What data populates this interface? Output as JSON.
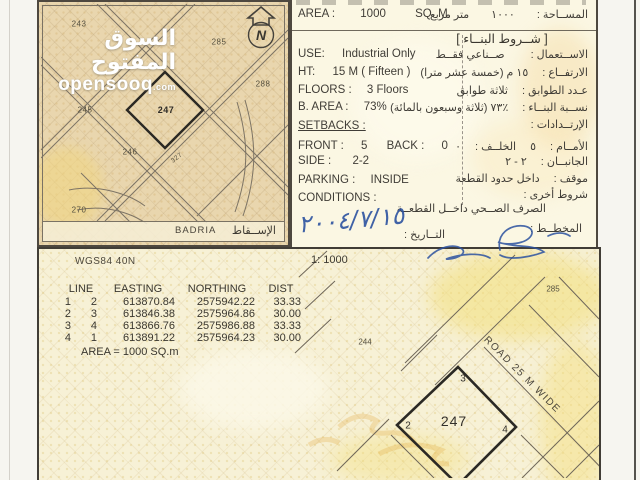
{
  "colors": {
    "paper": "#f6f5f0",
    "map_tan": "#e9d6ae",
    "form_cream": "#fbf7e3",
    "survey_pale": "#f7f1d6",
    "ink_blue": "#2c52a0",
    "line_dark": "#4a453d",
    "watermark_white": "#ffffff"
  },
  "watermark": {
    "brand_ar": "السوق المفتوح",
    "brand_domain": "opensooq",
    "brand_tld": ".com"
  },
  "top_map": {
    "north_letter": "N",
    "plots": {
      "p243": "243",
      "p285": "285",
      "p288": "288",
      "p245": "245",
      "p247": "247",
      "p246": "246",
      "p327": "327",
      "p270": "270"
    },
    "district_en": "BADRIA",
    "district_ar": "الإســقاط"
  },
  "form": {
    "area": {
      "en_label": "AREA :",
      "en_value": "1000",
      "en_unit": "SQ. M.",
      "ar_label": "المســاحة :",
      "ar_value": "١٠٠٠",
      "ar_unit": "متر مربع"
    },
    "building_terms_header": "[ شــروط البنــاء ]",
    "use": {
      "en_label": "USE:",
      "en_value": "Industrial Only",
      "ar_label": "الاســتعمال :",
      "ar_value": "صــناعي فقــط"
    },
    "height": {
      "en_label": "HT:",
      "en_value": "15 M  ( Fifteen )",
      "ar_label": "الارتفــاع :",
      "ar_value": "١٥ م  (خمسة عشر مترا)"
    },
    "floors": {
      "en_label": "FLOORS :",
      "en_value": "3 Floors",
      "ar_label": "عـدد الطوابق :",
      "ar_value": "ثلاثة طوابق"
    },
    "built_area": {
      "en_label": "B. AREA :",
      "en_value": "73%",
      "ar_label": "نســبة البنــاء :",
      "ar_value": "٪٧٣ (ثلاثة وسبعون بالمائة)"
    },
    "setbacks": {
      "en_label": "SETBACKS :",
      "ar_label": "الإرتــدادات :"
    },
    "front_back": {
      "en_label_front": "FRONT :",
      "en_value_front": "5",
      "en_label_back": "BACK :",
      "en_value_back": "0",
      "ar_label_front": "الأمــام :",
      "ar_value_front": "٥",
      "ar_label_back": "الخلــف :",
      "ar_value_back": "٠"
    },
    "side": {
      "en_label": "SIDE :",
      "en_value": "2-2",
      "ar_label": "الجانبــان :",
      "ar_value": "٢ - ٢"
    },
    "parking": {
      "en_label": "PARKING :",
      "en_value": "INSIDE",
      "ar_label": "موقف :",
      "ar_value": "داخل حدود القطعة"
    },
    "conditions": {
      "en_label": "CONDITIONS :",
      "ar_label": "شروط أخرى :",
      "ar_value": "الصرف الصــحي داخــل القطعــة"
    },
    "date": {
      "ar_label": "التــاريخ :",
      "value_handwritten": "٢٠٠٤/٧/١٥"
    },
    "planner": {
      "ar_label": "المخطــط :"
    }
  },
  "survey": {
    "datum": "WGS84 40N",
    "scale": "1: 1000",
    "table": {
      "headers": [
        "LINE",
        "EASTING",
        "NORTHING",
        "DIST"
      ],
      "rows": [
        [
          "1",
          "2",
          "613870.84",
          "2575942.22",
          "33.33"
        ],
        [
          "2",
          "3",
          "613846.38",
          "2575964.86",
          "30.00"
        ],
        [
          "3",
          "4",
          "613866.76",
          "2575986.88",
          "33.33"
        ],
        [
          "4",
          "1",
          "613891.22",
          "2575964.23",
          "30.00"
        ]
      ],
      "area_note": "AREA = 1000  SQ.m"
    }
  },
  "bottom_map": {
    "plot": "247",
    "corner_2": "2",
    "corner_3": "3",
    "corner_4": "4",
    "road_label": "ROAD 25 M WIDE",
    "neighbor_244": "244",
    "neighbor_285": "285"
  }
}
